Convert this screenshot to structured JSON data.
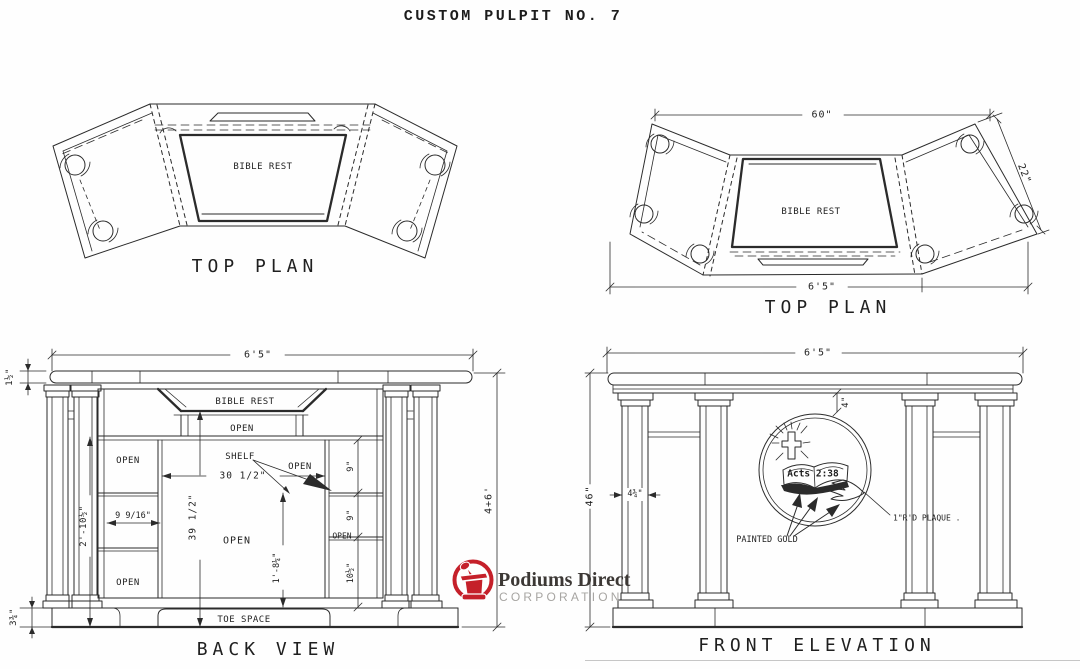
{
  "doc": {
    "title": "CUSTOM PULPIT NO. 7"
  },
  "top_plan_left": {
    "title": "TOP PLAN",
    "bible_rest_label": "BIBLE REST"
  },
  "top_plan_right": {
    "title": "TOP PLAN",
    "bible_rest_label": "BIBLE REST",
    "dim_top_width": "60\"",
    "dim_side_depth": "22\"",
    "dim_overall_width": "6'5\""
  },
  "back_view": {
    "title": "BACK VIEW",
    "bible_rest_label": "BIBLE REST",
    "shelf_label": "SHELF",
    "toe_space_label": "TOE SPACE",
    "open_under_bible_rest": "OPEN",
    "open_left_top": "OPEN",
    "open_left_bottom": "OPEN",
    "open_center": "OPEN",
    "open_right_of_shelf": "OPEN",
    "open_right_column": "OPEN",
    "dim_overall_width": "6'5\"",
    "dim_top_thickness": "1½\"",
    "dim_overall_height": "4+6'",
    "dim_open_height": "2'-10½\"",
    "dim_base_height": "3¾\"",
    "dim_shelf_width": "30 1/2\"",
    "dim_left_opening_width": "9 9/16\"",
    "dim_back_height": "39 1/2\"",
    "dim_center_opening_height": "1'-8¼\"",
    "dim_right_shelf_top": "9\"",
    "dim_right_shelf_mid": "9\"",
    "dim_right_shelf_bottom": "10½\""
  },
  "front_elevation": {
    "title": "FRONT ELEVATION",
    "dim_overall_width": "6'5\"",
    "dim_overall_height": "46\"",
    "dim_plaque_from_top": "4\"",
    "dim_column_width": "4¾\"",
    "plaque_text": "Acts 2:38",
    "painted_gold_label": "PAINTED GOLD",
    "plaque_note": "1\"R'D PLAQUE ."
  },
  "logo": {
    "brand": "Podiums Direct",
    "subtitle": "CORPORATION",
    "accent_color": "#c5202a",
    "brand_color": "#3c3835",
    "subtitle_color": "#a7a5a2"
  }
}
